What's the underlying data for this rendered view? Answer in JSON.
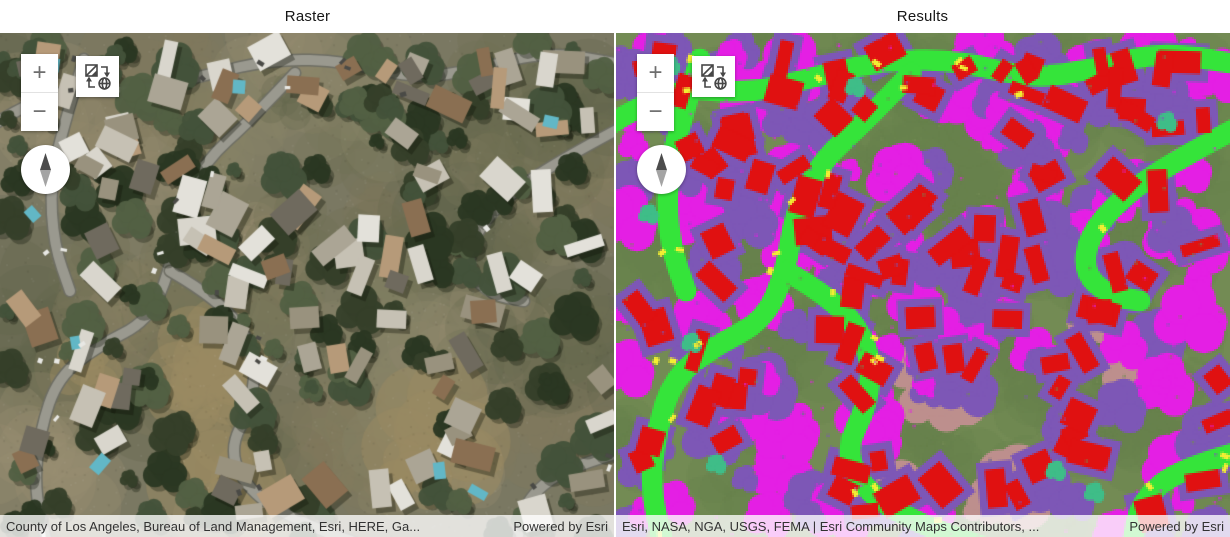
{
  "titles": {
    "left": "Raster",
    "right": "Results"
  },
  "controls": {
    "zoom_in_label": "+",
    "zoom_out_label": "−"
  },
  "attribution": {
    "left": {
      "sources": "County of Los Angeles, Bureau of Land Management, Esri, HERE, Ga...",
      "powered": "Powered by Esri"
    },
    "right": {
      "sources": "Esri, NASA, NGA, USGS, FEMA | Esri Community Maps Contributors, ...",
      "powered": "Powered by Esri"
    }
  },
  "map_colors": {
    "raster_panel": {
      "ground": "#7a7862",
      "terrain": [
        "#8a8468",
        "#6e7152",
        "#9c9072",
        "#60664a",
        "#837a5f"
      ],
      "brush": "#9a8a62",
      "tree": [
        "#35402a",
        "#2b3722",
        "#44523a",
        "#526044"
      ],
      "road_casing": "#6e6e64",
      "road": "#9a998f",
      "roof": [
        "#d9d6cd",
        "#c6c1b4",
        "#aba595",
        "#99927e",
        "#b69a79",
        "#8a6f52",
        "#6f6a5e",
        "#e3e1da"
      ],
      "pool": "#62b7c6",
      "car_light": "#e8e8e4",
      "car_dark": "#4a4a46"
    },
    "results_panel": {
      "background": "#738b54",
      "background_alt": "#67814b",
      "building": "#e01111",
      "building_halo": "#7d57b6",
      "road": "#35e43a",
      "tree_magenta": "#e41fe4",
      "tree_purple": "#7d57b6",
      "bare_ground": "#bd8f8d",
      "water": "#3fbd88",
      "vehicle": "#f2ee33"
    }
  }
}
